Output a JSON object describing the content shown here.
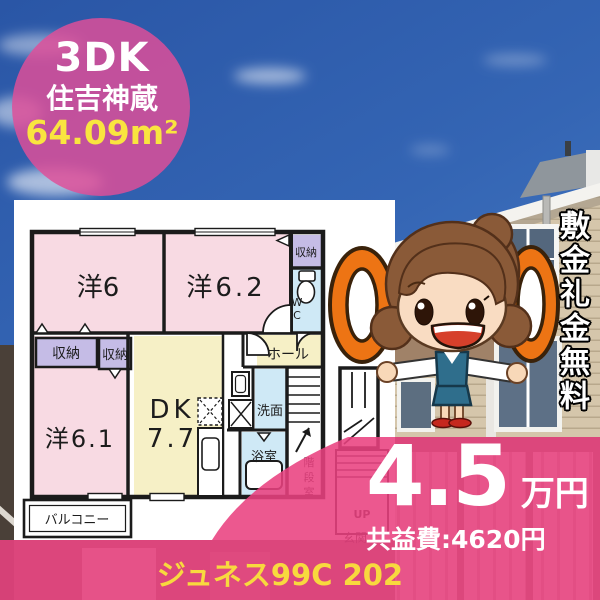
{
  "badge": {
    "layout": "3DK",
    "location": "住吉神蔵",
    "area": "64.09m²"
  },
  "floor_plan": {
    "rooms": {
      "bedroom1": "洋6",
      "bedroom2": "洋6.2",
      "closet_top": "収納",
      "wc_char1": "W",
      "wc_char2": "C",
      "closet_left1": "収納",
      "closet_left2": "収納",
      "hall": "ホール",
      "dk_label": "DK",
      "dk_size": "7.7",
      "bedroom3": "洋6.1",
      "washroom": "洗面",
      "bathroom": "浴室",
      "balcony": "バルコニー",
      "stairs_char1": "階",
      "stairs_char2": "段",
      "stairs_char3": "室",
      "up": "UP",
      "entrance": "玄関"
    }
  },
  "promo": {
    "vertical_text": "敷金礼金無料",
    "zero_icons": "00"
  },
  "price": {
    "rent": "4.5",
    "unit": "万円",
    "common_fee": "共益費:4620円"
  },
  "footer": {
    "building_name": "ジュネス99C 202"
  },
  "colors": {
    "overlay_pink": "#e9417f",
    "badge_pink": "#df4f99",
    "accent_yellow": "#f8d93e",
    "zero_orange": "#ed7414",
    "room_pink": "#f8dae3",
    "room_yellow": "#f6f0c6",
    "closet_lavender": "#c5bce6",
    "bath_blue": "#cfe9f6"
  }
}
